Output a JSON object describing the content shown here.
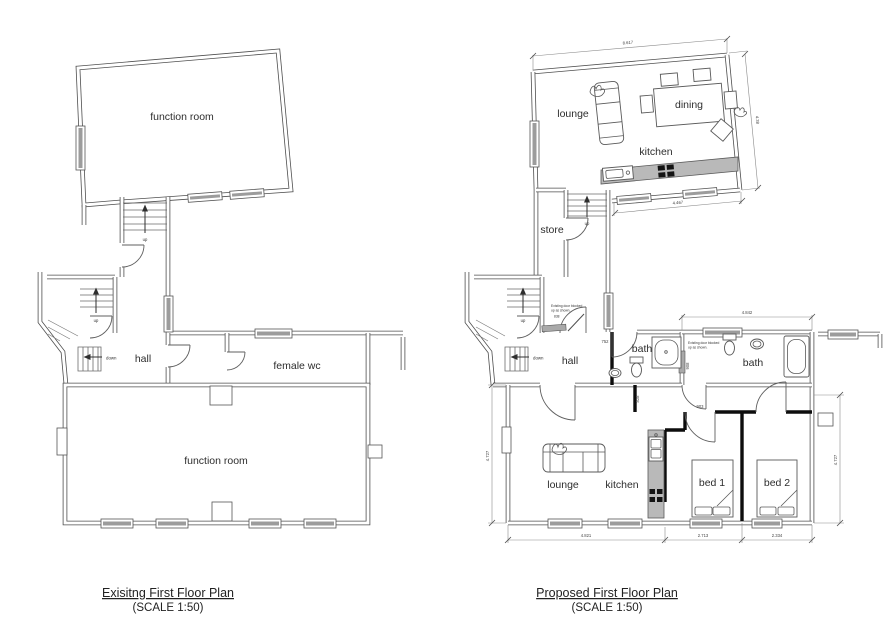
{
  "sheet": {
    "background": "#ffffff",
    "line_color": "#4f4f4f",
    "new_wall_color": "#0d0d0d",
    "counter_color": "#b9b9b9",
    "window_band_color": "#9c9c9c"
  },
  "existing": {
    "title": "Exisitng First Floor Plan",
    "scale_note": "(SCALE 1:50)",
    "rooms": {
      "function_room_top": "function room",
      "hall": "hall",
      "female_wc": "female wc",
      "function_room_bottom": "function room"
    },
    "stairs": {
      "up_top": "up",
      "up_hall": "up",
      "down": "down"
    }
  },
  "proposed": {
    "title": "Proposed First Floor Plan",
    "scale_note": "(SCALE 1:50)",
    "rooms": {
      "lounge_top": "lounge",
      "dining": "dining",
      "kitchen_top": "kitchen",
      "store": "store",
      "hall": "hall",
      "bath_middle": "bath",
      "bath_right": "bath",
      "lounge_bottom": "lounge",
      "kitchen_bottom": "kitchen",
      "bed_1": "bed 1",
      "bed_2": "bed 2"
    },
    "stairs": {
      "up_top": "up",
      "up_hall": "up",
      "down": "down"
    },
    "annotations": {
      "blocked_hall_line1": "Existing door blocked",
      "blocked_hall_line2": "up as shown.",
      "blocked_hall_number": "838",
      "blocked_bath_line1": "Existing door blocked",
      "blocked_bath_line2": "up as shown."
    },
    "dimensions": {
      "open_plan_width": "8.617",
      "open_plan_depth": "4.38",
      "kitchen_wall": "4.467",
      "bath_width": "4.842",
      "bottom_lounge": "4.821",
      "bottom_bed1": "2.713",
      "bottom_bed2": "2.334",
      "left_depth": "4.727",
      "right_depth": "4.727",
      "door_bath_middle": "752",
      "door_lobby": "828",
      "door_bed1": "903",
      "door_blocked_bath": "908"
    }
  }
}
